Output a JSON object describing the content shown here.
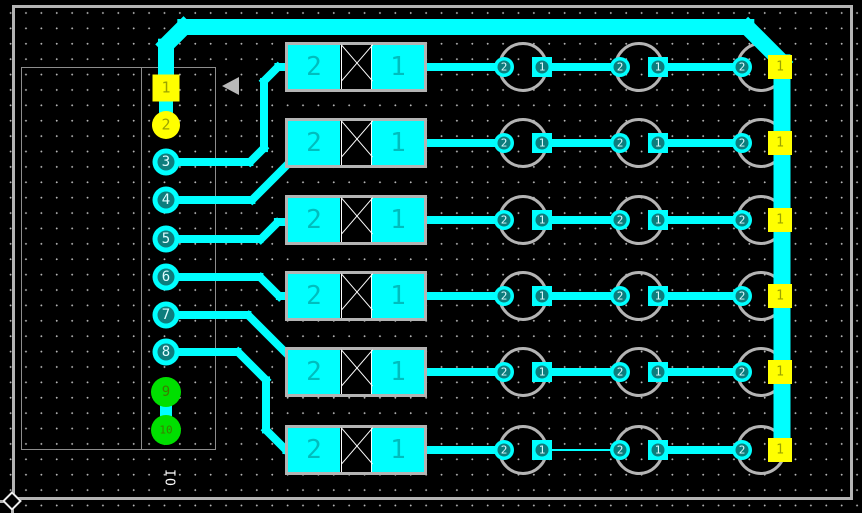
{
  "app": {
    "description": "PCB layout editor canvas"
  },
  "colors": {
    "background": "#000000",
    "grid_dot": "#b5b5b5",
    "copper": "#00ffff",
    "silkscreen": "#b4b4b4",
    "component_outline": "#8d8d8d",
    "board_border": "#b4b4b4",
    "pad_hole": "#0d7d7d",
    "pad_digit_light": "#dffcff",
    "pad_multilayer": "#ffff00",
    "pad_multilayer_digit": "#9aa300",
    "pad_power": "#00df00",
    "pad_power_digit": "#3c7c00",
    "diode_digit": "#00bdbd",
    "cross_mark": "#ffffff",
    "reference_text_color": "#ffffff"
  },
  "board": {
    "x": 12,
    "y": 5,
    "w": 841,
    "h": 495
  },
  "connector": {
    "reference": "IO",
    "outline": {
      "x": 21,
      "y": 67,
      "w": 195,
      "h": 383
    },
    "divider_x": 141,
    "ref_pos": {
      "x": 169,
      "y": 478
    },
    "pads": [
      {
        "n": "1",
        "shape": "square",
        "x": 166,
        "y": 88,
        "size": 27,
        "fill": "#ffff00",
        "digit": "#9aa300",
        "fs": 15
      },
      {
        "n": "2",
        "shape": "disc",
        "x": 166,
        "y": 125,
        "size": 28,
        "fill": "#ffff00",
        "digit": "#9aa300",
        "fs": 15
      },
      {
        "n": "3",
        "shape": "ring",
        "x": 166,
        "y": 162,
        "size": 27,
        "hole": 17,
        "fill": "#00ffff",
        "digit": "#dffcff",
        "fs": 14
      },
      {
        "n": "4",
        "shape": "ring",
        "x": 166,
        "y": 200,
        "size": 27,
        "hole": 17,
        "fill": "#00ffff",
        "digit": "#dffcff",
        "fs": 14
      },
      {
        "n": "5",
        "shape": "ring",
        "x": 166,
        "y": 239,
        "size": 27,
        "hole": 17,
        "fill": "#00ffff",
        "digit": "#dffcff",
        "fs": 14
      },
      {
        "n": "6",
        "shape": "ring",
        "x": 166,
        "y": 277,
        "size": 27,
        "hole": 17,
        "fill": "#00ffff",
        "digit": "#dffcff",
        "fs": 14
      },
      {
        "n": "7",
        "shape": "ring",
        "x": 166,
        "y": 315,
        "size": 27,
        "hole": 17,
        "fill": "#00ffff",
        "digit": "#dffcff",
        "fs": 14
      },
      {
        "n": "8",
        "shape": "ring",
        "x": 166,
        "y": 352,
        "size": 27,
        "hole": 17,
        "fill": "#00ffff",
        "digit": "#dffcff",
        "fs": 14
      },
      {
        "n": "9",
        "shape": "disc",
        "x": 166,
        "y": 392,
        "size": 30,
        "fill": "#00df00",
        "digit": "#3c7c00",
        "fs": 14
      },
      {
        "n": "10",
        "shape": "disc",
        "x": 166,
        "y": 430,
        "size": 30,
        "fill": "#00df00",
        "digit": "#3c7c00",
        "fs": 11
      }
    ]
  },
  "pointer_arrow": {
    "x": 222,
    "y": 77
  },
  "rows": [
    {
      "y": 67
    },
    {
      "y": 143
    },
    {
      "y": 220
    },
    {
      "y": 296
    },
    {
      "y": 372
    },
    {
      "y": 450,
      "thin_mid": true
    }
  ],
  "diode": {
    "x": 285,
    "w": 142,
    "h": 50,
    "pad_w": 52,
    "pad_h": 44,
    "gap_x1": 341,
    "gap_x2": 372,
    "labels": [
      "2",
      "1"
    ],
    "label_x": [
      314,
      398
    ],
    "digit_fs": 26
  },
  "led": {
    "ring_r": 25,
    "pad": 20,
    "hole": 13,
    "labels": [
      "2",
      "1"
    ],
    "digit_fs": 11,
    "cols": [
      {
        "cx": 523,
        "pad2_x": 504,
        "pad1_x": 542,
        "supply": false
      },
      {
        "cx": 639,
        "pad2_x": 620,
        "pad1_x": 658,
        "supply": false
      },
      {
        "cx": 761,
        "pad2_x": 742,
        "pad1_x": 780,
        "supply": true
      }
    ],
    "supply_pad": {
      "size": 24,
      "label": "1",
      "digit_fs": 13
    }
  },
  "row_traces": {
    "a": [
      420,
      504
    ],
    "b": [
      542,
      620
    ],
    "c": [
      658,
      742
    ],
    "w": 8,
    "thin_w": 2
  },
  "traces": [
    {
      "seg": [
        166,
        92,
        166,
        45
      ],
      "w": 16,
      "name": "supply-trace-riser"
    },
    {
      "seg": [
        166,
        45,
        184,
        27
      ],
      "w": 16,
      "name": "supply-trace-bend"
    },
    {
      "seg": [
        184,
        27,
        747,
        27
      ],
      "w": 16,
      "name": "supply-trace-top"
    },
    {
      "seg": [
        747,
        27,
        782,
        62
      ],
      "w": 16,
      "name": "supply-trace-bend"
    },
    {
      "seg": [
        782,
        62,
        782,
        452
      ],
      "w": 17,
      "name": "supply-trace-right"
    },
    {
      "seg": [
        166,
        88,
        166,
        125
      ],
      "w": 14,
      "name": "pad1-pad2-stub"
    },
    {
      "seg": [
        166,
        392,
        166,
        430
      ],
      "w": 12,
      "name": "pad9-pad10-stub"
    },
    {
      "seg": [
        166,
        162,
        250,
        162
      ],
      "w": 8,
      "name": "net3-trace"
    },
    {
      "seg": [
        250,
        162,
        264,
        148
      ],
      "w": 8,
      "name": "net3-trace"
    },
    {
      "seg": [
        264,
        148,
        264,
        81
      ],
      "w": 8,
      "name": "net3-trace"
    },
    {
      "seg": [
        264,
        81,
        278,
        67
      ],
      "w": 8,
      "name": "net3-trace"
    },
    {
      "seg": [
        278,
        67,
        298,
        67
      ],
      "w": 8,
      "name": "net3-trace"
    },
    {
      "seg": [
        166,
        200,
        252,
        200
      ],
      "w": 8,
      "name": "net4-trace"
    },
    {
      "seg": [
        252,
        200,
        308,
        144
      ],
      "w": 8,
      "name": "net4-trace"
    },
    {
      "seg": [
        166,
        239,
        260,
        239
      ],
      "w": 8,
      "name": "net5-trace"
    },
    {
      "seg": [
        260,
        239,
        277,
        222
      ],
      "w": 8,
      "name": "net5-trace"
    },
    {
      "seg": [
        277,
        222,
        298,
        222
      ],
      "w": 8,
      "name": "net5-trace"
    },
    {
      "seg": [
        166,
        277,
        260,
        277
      ],
      "w": 8,
      "name": "net6-trace"
    },
    {
      "seg": [
        260,
        277,
        279,
        296
      ],
      "w": 8,
      "name": "net6-trace"
    },
    {
      "seg": [
        279,
        296,
        298,
        296
      ],
      "w": 8,
      "name": "net6-trace"
    },
    {
      "seg": [
        166,
        315,
        248,
        315
      ],
      "w": 8,
      "name": "net7-trace"
    },
    {
      "seg": [
        248,
        315,
        305,
        372
      ],
      "w": 8,
      "name": "net7-trace"
    },
    {
      "seg": [
        166,
        352,
        238,
        352
      ],
      "w": 8,
      "name": "net8-trace"
    },
    {
      "seg": [
        238,
        352,
        266,
        380
      ],
      "w": 8,
      "name": "net8-trace"
    },
    {
      "seg": [
        266,
        380,
        266,
        430
      ],
      "w": 8,
      "name": "net8-trace"
    },
    {
      "seg": [
        266,
        430,
        286,
        450
      ],
      "w": 8,
      "name": "net8-trace"
    },
    {
      "seg": [
        286,
        450,
        300,
        450
      ],
      "w": 8,
      "name": "net8-trace"
    }
  ],
  "board_marks": {
    "bottom_ext": {
      "x": 0,
      "y": 499.5,
      "w": 12,
      "h": 3
    },
    "left_ext": {
      "x": 10.5,
      "y": 501,
      "w": 3,
      "h": 12
    }
  }
}
